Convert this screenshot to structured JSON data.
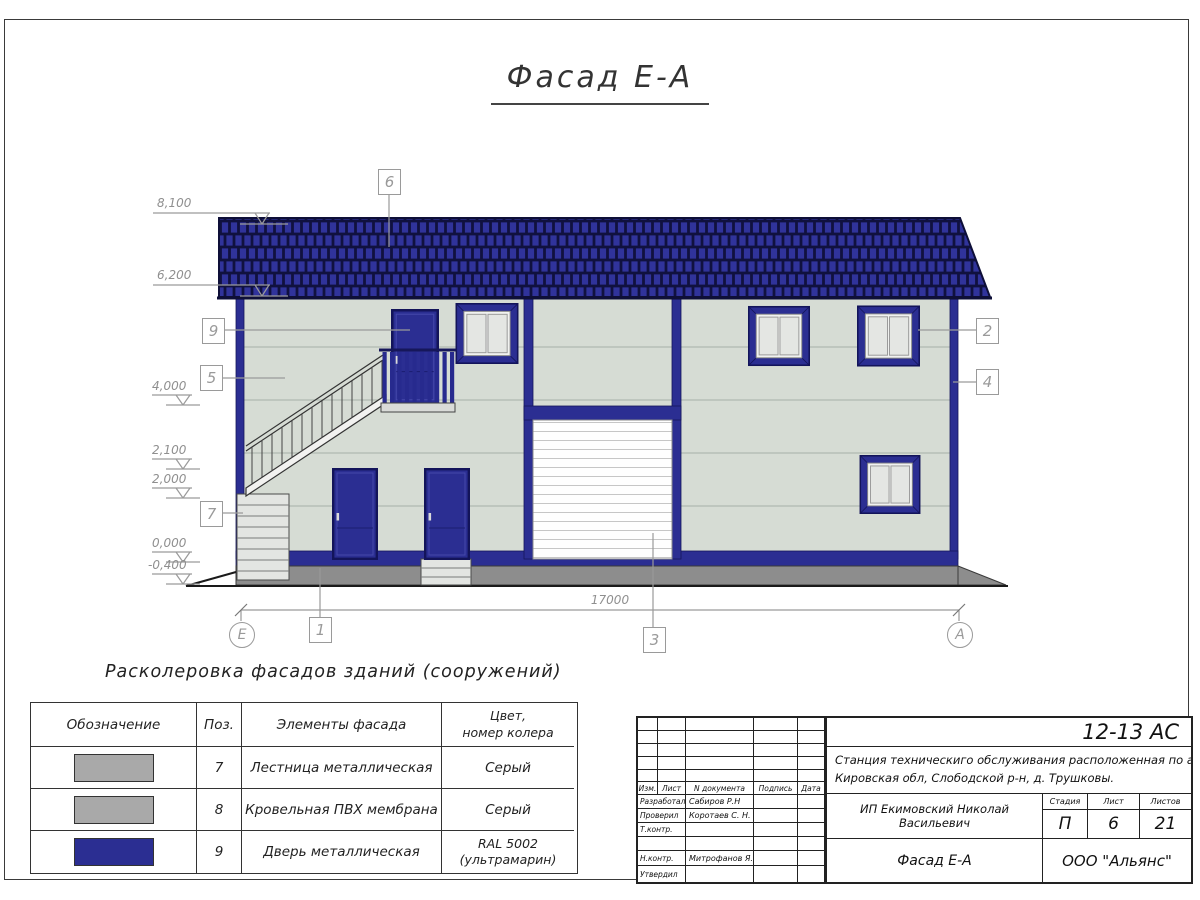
{
  "sheet": {
    "title": "Фасад Е-А"
  },
  "annotations": {
    "elevations": [
      {
        "v": "8,100"
      },
      {
        "v": "6,200"
      },
      {
        "v": "4,000"
      },
      {
        "v": "2,100"
      },
      {
        "v": "2,000"
      },
      {
        "v": "0,000"
      },
      {
        "v": "-0,400"
      }
    ],
    "dimension_total": "17000",
    "axis_left": "Е",
    "axis_right": "А",
    "callouts": {
      "roof": "6",
      "upper_door": "9",
      "wall": "5",
      "stairs": "7",
      "window": "2",
      "corner": "4",
      "plinth": "1",
      "garage": "3"
    }
  },
  "legend": {
    "heading": "Расколеровка фасадов зданий (сооружений)",
    "headers": {
      "designation": "Обозначение",
      "pos": "Поз.",
      "elements": "Элементы фасада",
      "color_line1": "Цвет,",
      "color_line2": "номер колера"
    },
    "rows": [
      {
        "pos": "7",
        "element": "Лестница металлическая",
        "color": "Серый"
      },
      {
        "pos": "8",
        "element": "Кровельная ПВХ мембрана",
        "color": "Серый"
      },
      {
        "pos": "9",
        "element": "Дверь металлическая",
        "color_line1": "RAL 5002",
        "color_line2": "(ультрамарин)"
      }
    ]
  },
  "stamp": {
    "doc_number": "12-13 АС",
    "project_line1": "Станция техническиго обслуживания расположенная по адресу",
    "project_line2": "Кировская обл, Слободской р-н, д. Трушковы.",
    "client": "ИП Екимовский Николай Васильевич",
    "sheet_name": "Фасад Е-А",
    "company": "ООО \"Альянс\"",
    "stage_label": "Стадия",
    "stage_value": "П",
    "list_label": "Лист",
    "list_value": "6",
    "listov_label": "Листов",
    "listov_value": "21",
    "cols": {
      "izm": "Изм.",
      "list": "Лист",
      "doc": "N документа",
      "sign": "Подпись",
      "date": "Дата"
    },
    "roles": [
      {
        "role": "Разработал",
        "name": "Сабиров Р.Н"
      },
      {
        "role": "Проверил",
        "name": "Коротаев С. Н."
      },
      {
        "role": "Т.контр.",
        "name": ""
      },
      {
        "role": "",
        "name": ""
      },
      {
        "role": "Н.контр.",
        "name": "Митрофанов Я. А."
      },
      {
        "role": "Утвердил",
        "name": ""
      }
    ]
  },
  "colors": {
    "roof_door_blue": "#2b2e92",
    "wall_panel": "#d6dcd4",
    "plinth_gray": "#8d8d8d",
    "legend_gray": "#a9a9a9",
    "ral_5002": "#2b2e92"
  }
}
